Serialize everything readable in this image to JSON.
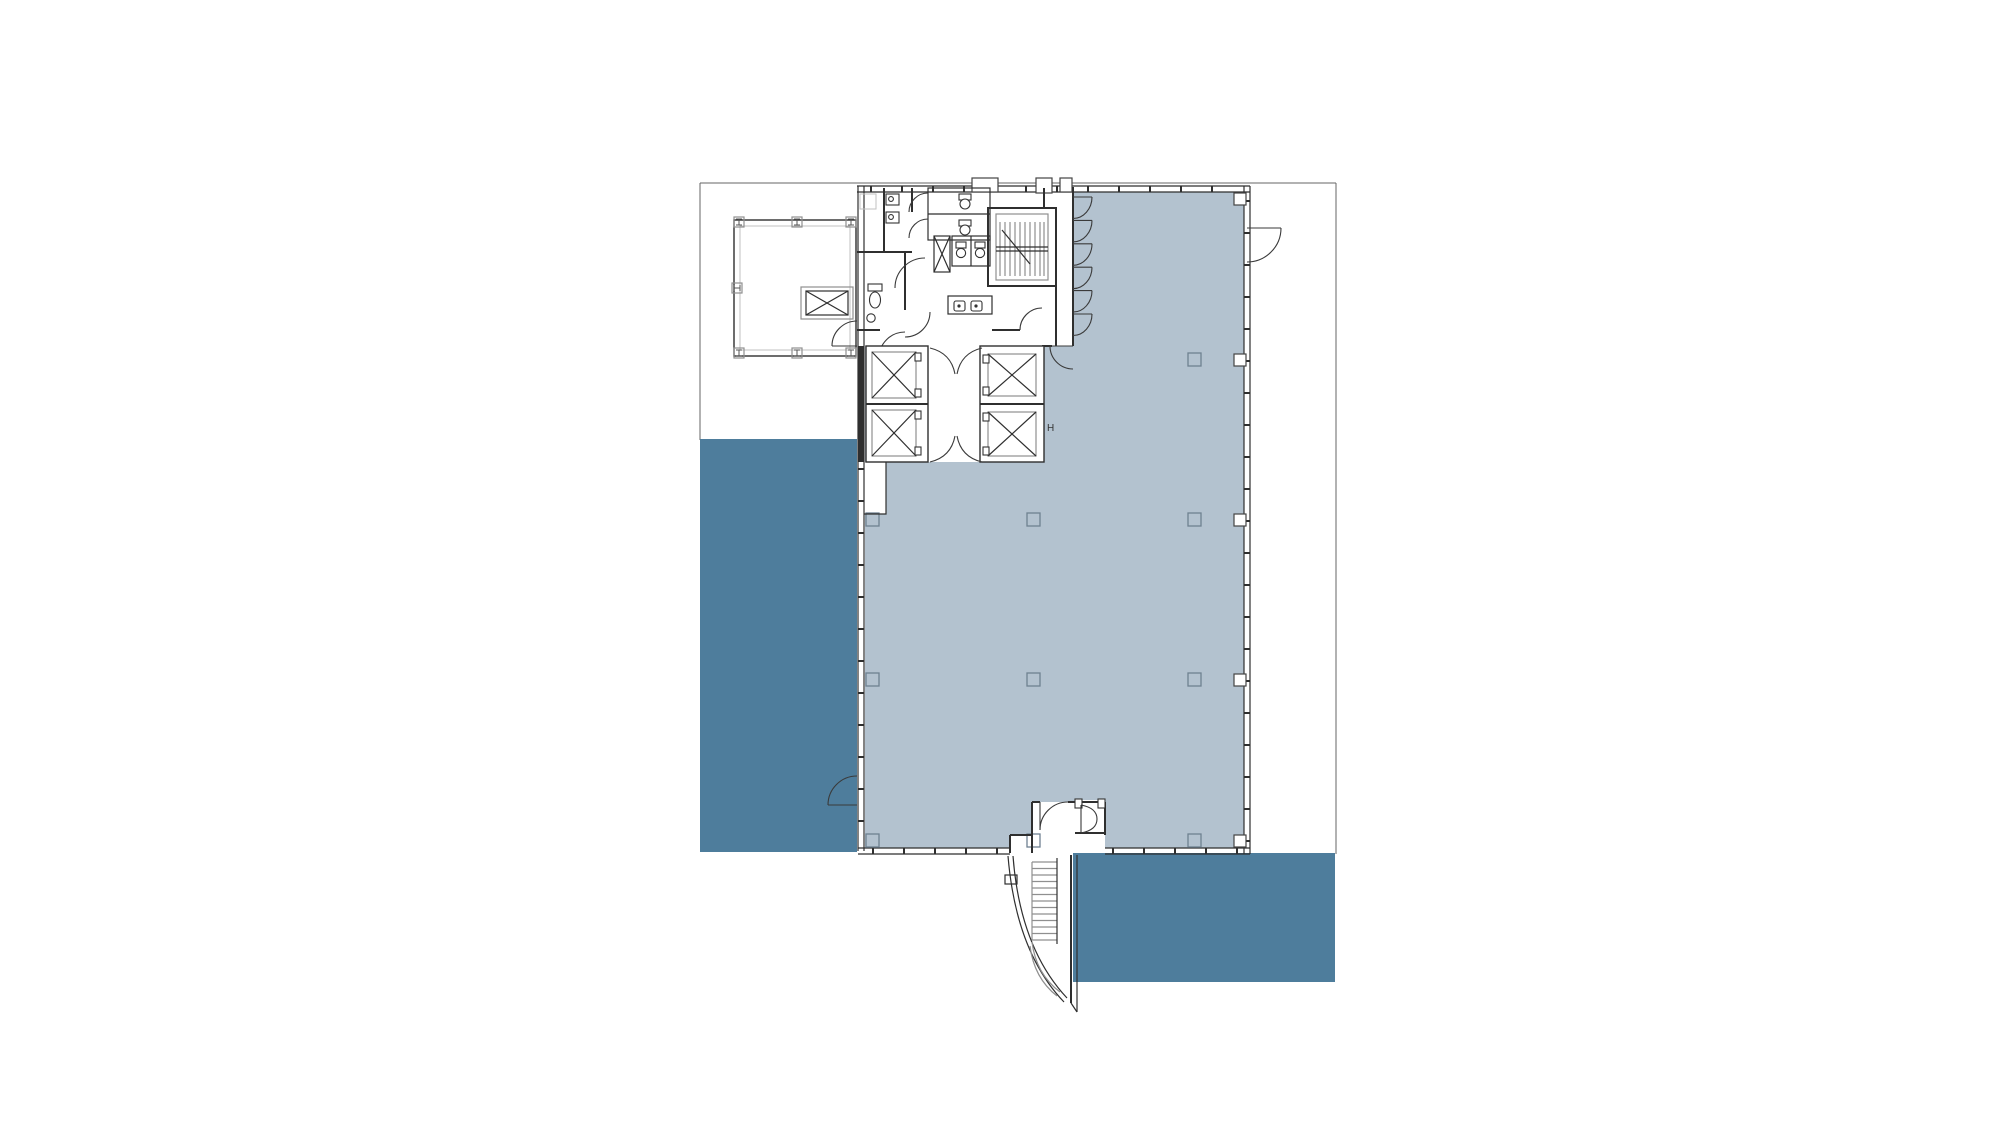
{
  "drawing": {
    "title": "building-floor-plan",
    "elevator_label": "H"
  },
  "colors": {
    "background": "#ffffff",
    "zone_light": "#b3c2cf",
    "zone_dark": "#4e7d9c",
    "wall": "#2f2f2f",
    "gray": "#8f8f8f",
    "light_gray": "#c2c2c2",
    "column": "#6f8191"
  }
}
